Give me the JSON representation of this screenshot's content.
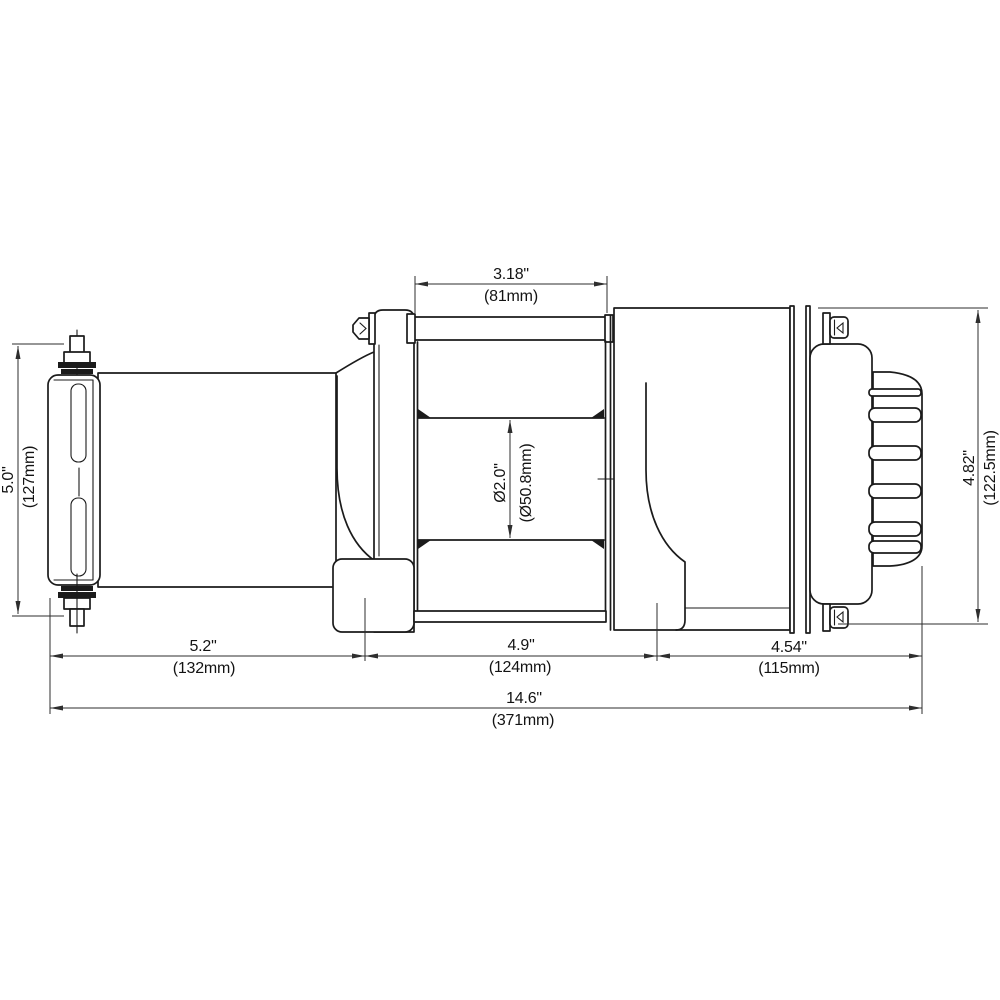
{
  "dimensions": {
    "drum_width": {
      "inches": "3.18\"",
      "mm": "(81mm)"
    },
    "fairlead_height": {
      "inches": "5.0\"",
      "mm": "(127mm)"
    },
    "drum_diameter": {
      "inches": "Ø2.0\"",
      "mm": "(Ø50.8mm)"
    },
    "motor_height": {
      "inches": "4.82\"",
      "mm": "(122.5mm)"
    },
    "fairlead_section_width": {
      "inches": "5.2\"",
      "mm": "(132mm)"
    },
    "drum_section_width": {
      "inches": "4.9\"",
      "mm": "(124mm)"
    },
    "motor_section_width": {
      "inches": "4.54\"",
      "mm": "(115mm)"
    },
    "overall_length": {
      "inches": "14.6\"",
      "mm": "(371mm)"
    }
  }
}
